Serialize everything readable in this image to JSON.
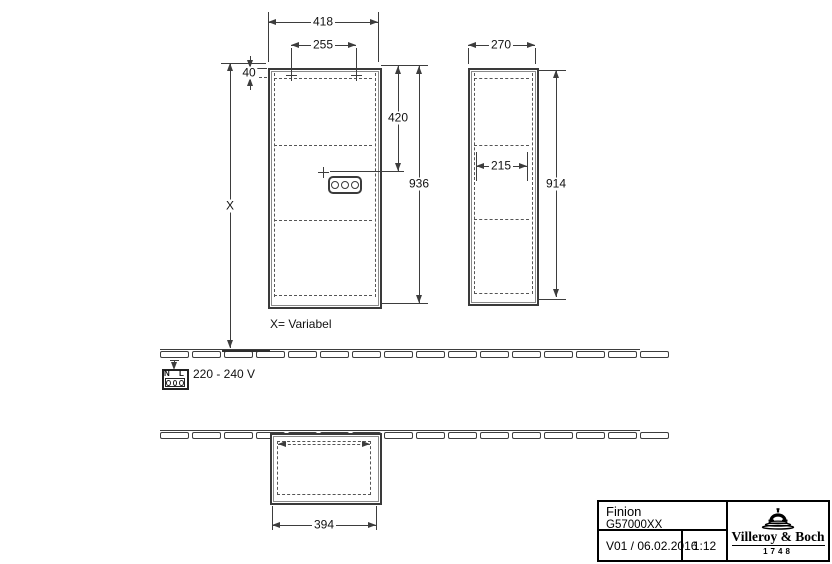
{
  "drawing": {
    "note_variable": "X= Variabel",
    "voltage": "220 - 240 V",
    "dims": {
      "front_width": "418",
      "front_hole_spacing": "255",
      "hanger_offset": "40",
      "x_var": "X",
      "upper_section": "420",
      "front_height": "936",
      "side_depth": "270",
      "side_inner": "215",
      "side_height": "914",
      "plan_width": "394"
    },
    "socket_labels": {
      "n": "N",
      "l": "L"
    }
  },
  "title_block": {
    "product": "Finion",
    "article": "G57000XX",
    "version_date": "V01 / 06.02.2016",
    "scale": "1:12",
    "brand": "Villeroy & Boch",
    "year": "1748"
  }
}
